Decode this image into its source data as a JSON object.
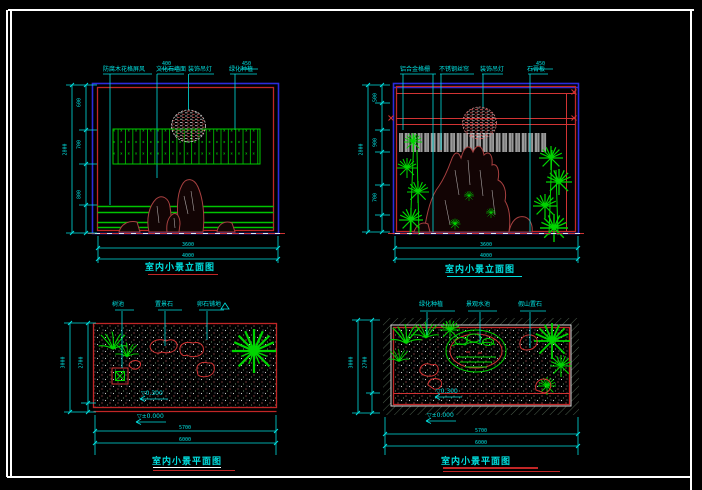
{
  "sheet": {
    "background": "#000000",
    "frame_color": "#ffffff"
  },
  "palette": {
    "annotation_cyan": "#00dfdf",
    "border_red": "#c22626",
    "border_blue": "#2b2bdd",
    "plant_green": "#00d400",
    "rock_maroon": "#a84040",
    "curtain_gray": "#9b9b9b",
    "ground_white": "#e8e8e8"
  },
  "views": {
    "tl": {
      "type": "elevation",
      "title": "室内小景立面图",
      "labels": [
        "防腐木花格屏风",
        "文化石墙面",
        "装饰吊灯",
        "绿化种植"
      ],
      "label_dims": [
        "400",
        "450"
      ],
      "left_dims": {
        "overall": "2800",
        "segments": [
          "600",
          "700",
          "800"
        ]
      },
      "bottom_dims": [
        "3600",
        "4000"
      ]
    },
    "tr": {
      "type": "elevation",
      "title": "室内小景立面图",
      "labels": [
        "铝合金格栅",
        "不锈钢丝帘",
        "装饰吊灯",
        "石膏板"
      ],
      "label_dims": [
        "450"
      ],
      "left_dims": {
        "overall": "2800",
        "segments": [
          "500",
          "900",
          "700"
        ]
      },
      "bottom_dims": [
        "3600",
        "4000"
      ]
    },
    "bl": {
      "type": "plan",
      "title": "室内小景平面图",
      "labels": [
        "树池",
        "置景石",
        "卵石铺地"
      ],
      "notes": [
        "▽0.300",
        "▽±0.000"
      ],
      "left_dims": {
        "overall": "3000",
        "segments": [
          "2700"
        ]
      },
      "bottom_dims": [
        "5700",
        "6000"
      ]
    },
    "br": {
      "type": "plan",
      "title": "室内小景平面图",
      "labels": [
        "绿化种植",
        "景观水池",
        "假山置石"
      ],
      "notes": [
        "▽0.300",
        "▽±0.000"
      ],
      "left_dims": {
        "overall": "3000",
        "segments": [
          "2700"
        ]
      },
      "bottom_dims": [
        "5700",
        "6000"
      ]
    }
  }
}
